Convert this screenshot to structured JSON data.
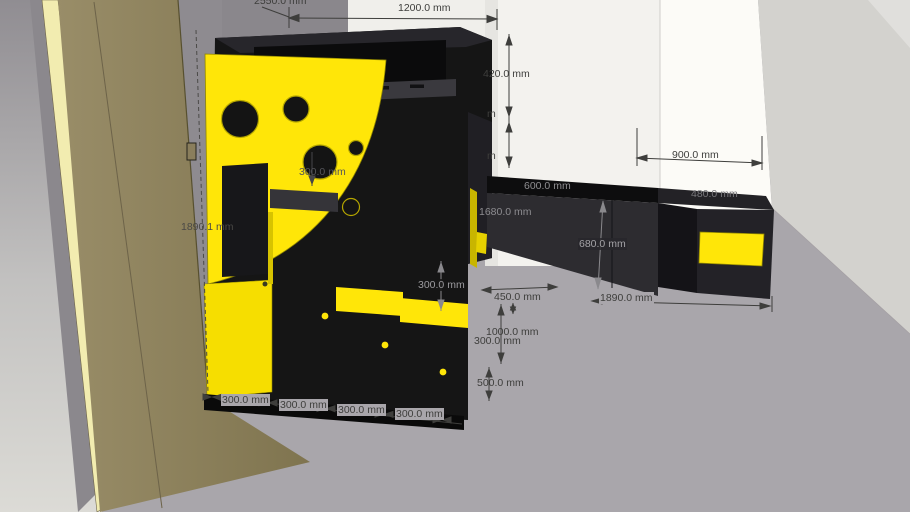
{
  "viewport": {
    "type": "3d-model-view",
    "unit": "mm",
    "colors": {
      "floor": "#a9a6ab",
      "accent_yellow": "#ffe608",
      "structure_black": "#151515",
      "door_brown": "#8f8361",
      "door_edge": "#f2ecb0",
      "wall_white": "#f3f2ee",
      "wall_gray": "#8a878c",
      "dim_text": "#3e3e3c"
    },
    "objects": [
      "left-wall",
      "door-panel",
      "door-hinge",
      "yellow-quarter-panel",
      "stair-structure",
      "upper-cabinet",
      "counter-cabinet",
      "right-cabinet",
      "yellow-drawer-front",
      "white-wall",
      "right-wall",
      "floor"
    ]
  },
  "dimensions": [
    {
      "id": "wall-height",
      "label": "2550.0 mm"
    },
    {
      "id": "top-width",
      "label": "1200.0 mm"
    },
    {
      "id": "upper-cabinet-h",
      "label": "420.0 mm"
    },
    {
      "id": "hidden-dim-upper",
      "label": "m"
    },
    {
      "id": "hidden-dim-lower",
      "label": "m"
    },
    {
      "id": "right-wall-width",
      "label": "900.0 mm"
    },
    {
      "id": "counter-depth",
      "label": "600.0 mm"
    },
    {
      "id": "right-cabinet-w",
      "label": "480.0 mm"
    },
    {
      "id": "structure-height",
      "label": "1680.0 mm"
    },
    {
      "id": "counter-height",
      "label": "680.0 mm"
    },
    {
      "id": "door-height",
      "label": "1890.1 mm"
    },
    {
      "id": "front-gap",
      "label": "450.0 mm"
    },
    {
      "id": "counter-run",
      "label": "1890.0 mm"
    },
    {
      "id": "rise-1000",
      "label": "1000.0 mm"
    },
    {
      "id": "rise-overlap-300",
      "label": "300.0 mm"
    },
    {
      "id": "base-500",
      "label": "500.0 mm"
    },
    {
      "id": "step-rise-300",
      "label": "300.0 mm"
    },
    {
      "id": "panel-300",
      "label": "300.0 mm"
    },
    {
      "id": "tread-1",
      "label": "300.0 mm"
    },
    {
      "id": "tread-2",
      "label": "300.0 mm"
    },
    {
      "id": "tread-3",
      "label": "300.0 mm"
    },
    {
      "id": "tread-4",
      "label": "300.0 mm"
    }
  ]
}
